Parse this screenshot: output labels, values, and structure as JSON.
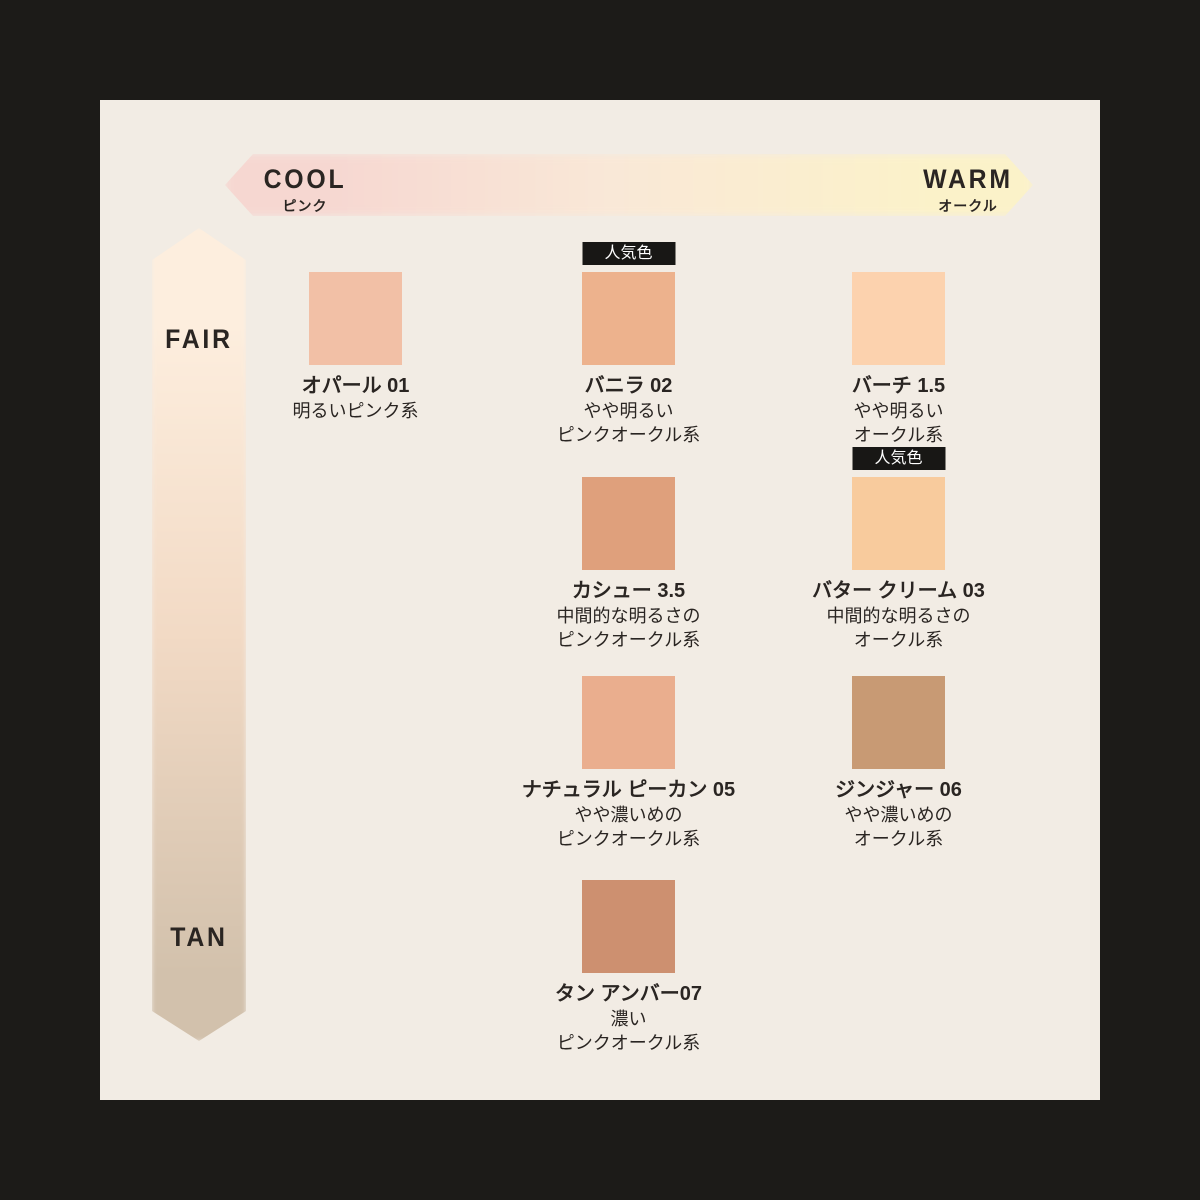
{
  "panel": {
    "background": "#f2ece4",
    "outer_background": "#1c1b18",
    "text_color": "#2a2522"
  },
  "axes": {
    "horizontal": {
      "left_label": "COOL",
      "left_sublabel": "ピンク",
      "right_label": "WARM",
      "right_sublabel": "オークル",
      "gradient_left": "#f6d7d1",
      "gradient_mid": "#f9e8d7",
      "gradient_right": "#fbf2c9"
    },
    "vertical": {
      "top_label": "FAIR",
      "bottom_label": "TAN",
      "gradient_top": "#fdeede",
      "gradient_mid": "#f2dac5",
      "gradient_bottom": "#d2c1ac"
    }
  },
  "badge_label": "人気色",
  "badge_colors": {
    "background": "#181715",
    "text": "#ffffff"
  },
  "shades": [
    {
      "name": "オパール 01",
      "desc": [
        "明るいピンク系"
      ],
      "color": "#f2c0a6",
      "popular": false,
      "col": 0,
      "row": 0
    },
    {
      "name": "バニラ 02",
      "desc": [
        "やや明るい",
        "ピンクオークル系"
      ],
      "color": "#edb28d",
      "popular": true,
      "col": 1,
      "row": 0
    },
    {
      "name": "バーチ 1.5",
      "desc": [
        "やや明るい",
        "オークル系"
      ],
      "color": "#fcd2ae",
      "popular": false,
      "col": 2,
      "row": 0
    },
    {
      "name": "カシュー 3.5",
      "desc": [
        "中間的な明るさの",
        "ピンクオークル系"
      ],
      "color": "#dfa07c",
      "popular": false,
      "col": 1,
      "row": 1
    },
    {
      "name": "バター クリーム 03",
      "desc": [
        "中間的な明るさの",
        "オークル系"
      ],
      "color": "#f8cb9d",
      "popular": true,
      "col": 2,
      "row": 1
    },
    {
      "name": "ナチュラル ピーカン 05",
      "desc": [
        "やや濃いめの",
        "ピンクオークル系"
      ],
      "color": "#eaae8e",
      "popular": false,
      "col": 1,
      "row": 2
    },
    {
      "name": "ジンジャー 06",
      "desc": [
        "やや濃いめの",
        "オークル系"
      ],
      "color": "#c89a74",
      "popular": false,
      "col": 2,
      "row": 2
    },
    {
      "name": "タン アンバー07",
      "desc": [
        "濃い",
        "ピンクオークル系"
      ],
      "color": "#cd9070",
      "popular": false,
      "col": 1,
      "row": 3
    }
  ]
}
